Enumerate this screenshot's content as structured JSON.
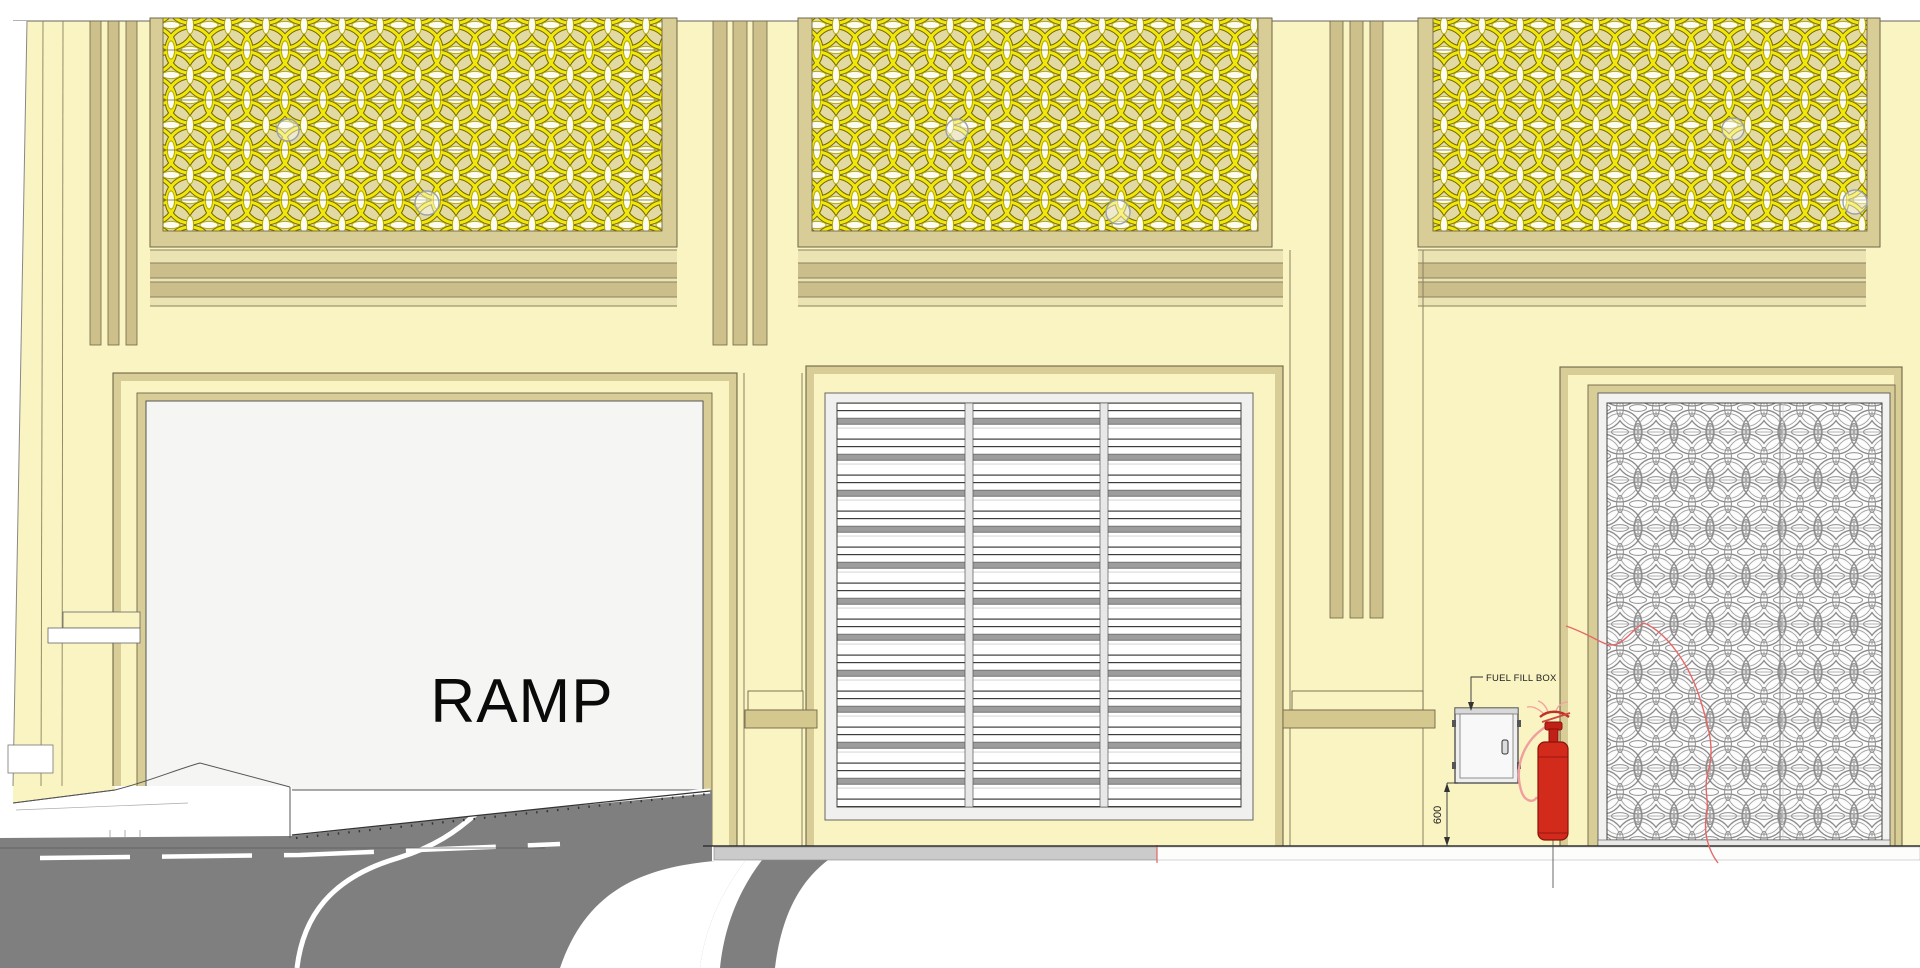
{
  "labels": {
    "ramp": "RAMP",
    "fuel_fill_box": "FUEL FILL BOX",
    "dim_600": "600"
  },
  "colors": {
    "wall": "#FAF3C2",
    "panel_bg": "#E3D9A2",
    "pattern_yellow": "#F2E70C",
    "pattern_outline": "#6F6600",
    "frame_tan": "#D9CD97",
    "band_light": "#ECE3B2",
    "band_dark": "#CBBE8A",
    "opening_gray": "#F5F5F3",
    "louver_white": "#FFFFFF",
    "louver_slat_gray": "#9D9D9D",
    "road_gray": "#7F7F7F",
    "curb_gray": "#CBCBCB",
    "extinguisher_red": "#D22B1C",
    "hose_pink": "#EF9F9F",
    "arc_red": "#E46868",
    "line_dark": "#6F6747"
  },
  "structure": {
    "top_decorative_panels": 3,
    "louver_columns": 3,
    "door_leaves": 2,
    "pilaster_grooves_per_pilaster": 3
  }
}
